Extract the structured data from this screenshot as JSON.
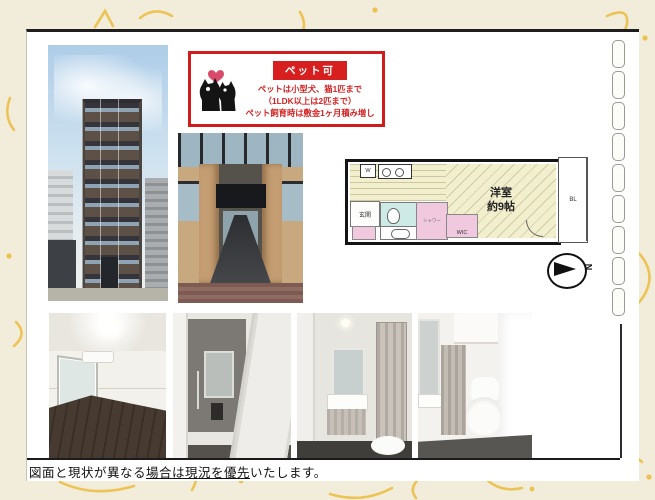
{
  "pet_notice": {
    "badge": "ペット可",
    "lines": [
      "ペットは小型犬、猫1匹まで",
      "（1LDK以上は2匹まで）",
      "ペット飼育時は敷金1ヶ月積み増し"
    ],
    "accent_color": "#d71f1f"
  },
  "floor_plan": {
    "room_name": "洋室",
    "room_size": "約9帖",
    "entrance_label": "玄関",
    "washer_label": "W",
    "wic_label": "WIC",
    "shower_label": "シャワー",
    "balcony_label": "BL",
    "compass_label": "N",
    "colors": {
      "floor_cream": "#f2efcf",
      "wet_area_pink": "#f0c9de",
      "toilet_teal": "#cdeae6"
    }
  },
  "footer": {
    "prefix": "図面と現状が異なる",
    "underlined": "場合は現況を優先",
    "suffix": "いたします。"
  }
}
